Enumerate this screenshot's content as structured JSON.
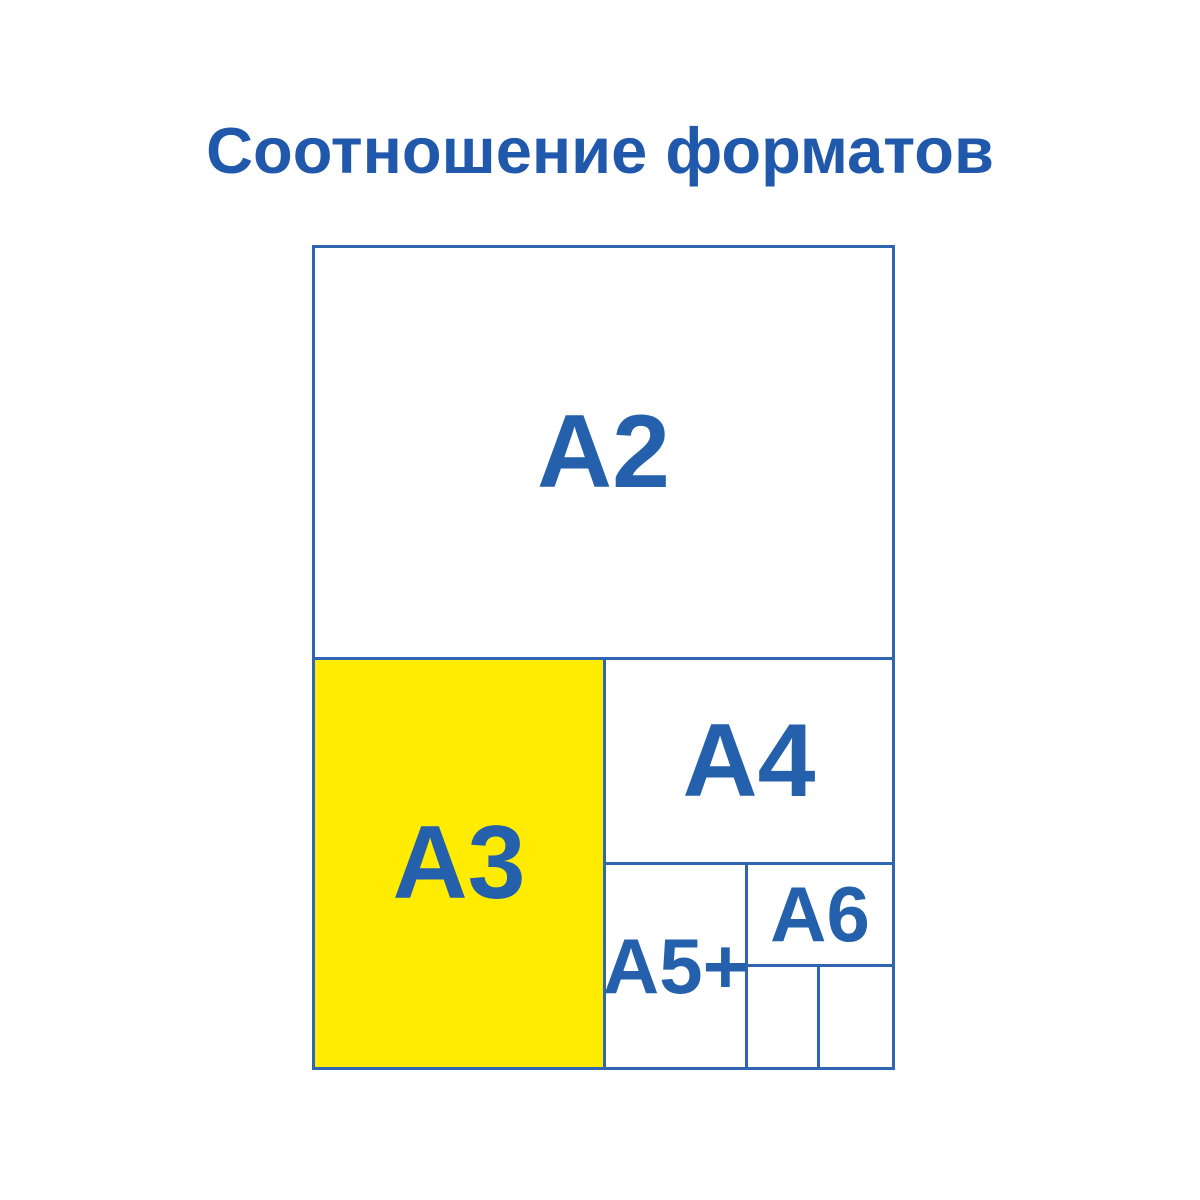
{
  "title": "Соотношение форматов",
  "colors": {
    "text_blue": "#2560ac",
    "title_blue": "#2058ac",
    "border_blue": "#3065b2",
    "highlight_yellow": "#ffec00",
    "background": "#ffffff"
  },
  "diagram": {
    "description": "Nested paper size comparison chart",
    "cells": [
      {
        "id": "a2",
        "label": "A2",
        "highlighted": false
      },
      {
        "id": "a3",
        "label": "A3",
        "highlighted": true
      },
      {
        "id": "a4",
        "label": "A4",
        "highlighted": false
      },
      {
        "id": "a5plus",
        "label": "A5+",
        "highlighted": false
      },
      {
        "id": "a6",
        "label": "A6",
        "highlighted": false
      },
      {
        "id": "a7-left",
        "label": "",
        "highlighted": false
      },
      {
        "id": "a7-right",
        "label": "",
        "highlighted": false
      }
    ]
  }
}
